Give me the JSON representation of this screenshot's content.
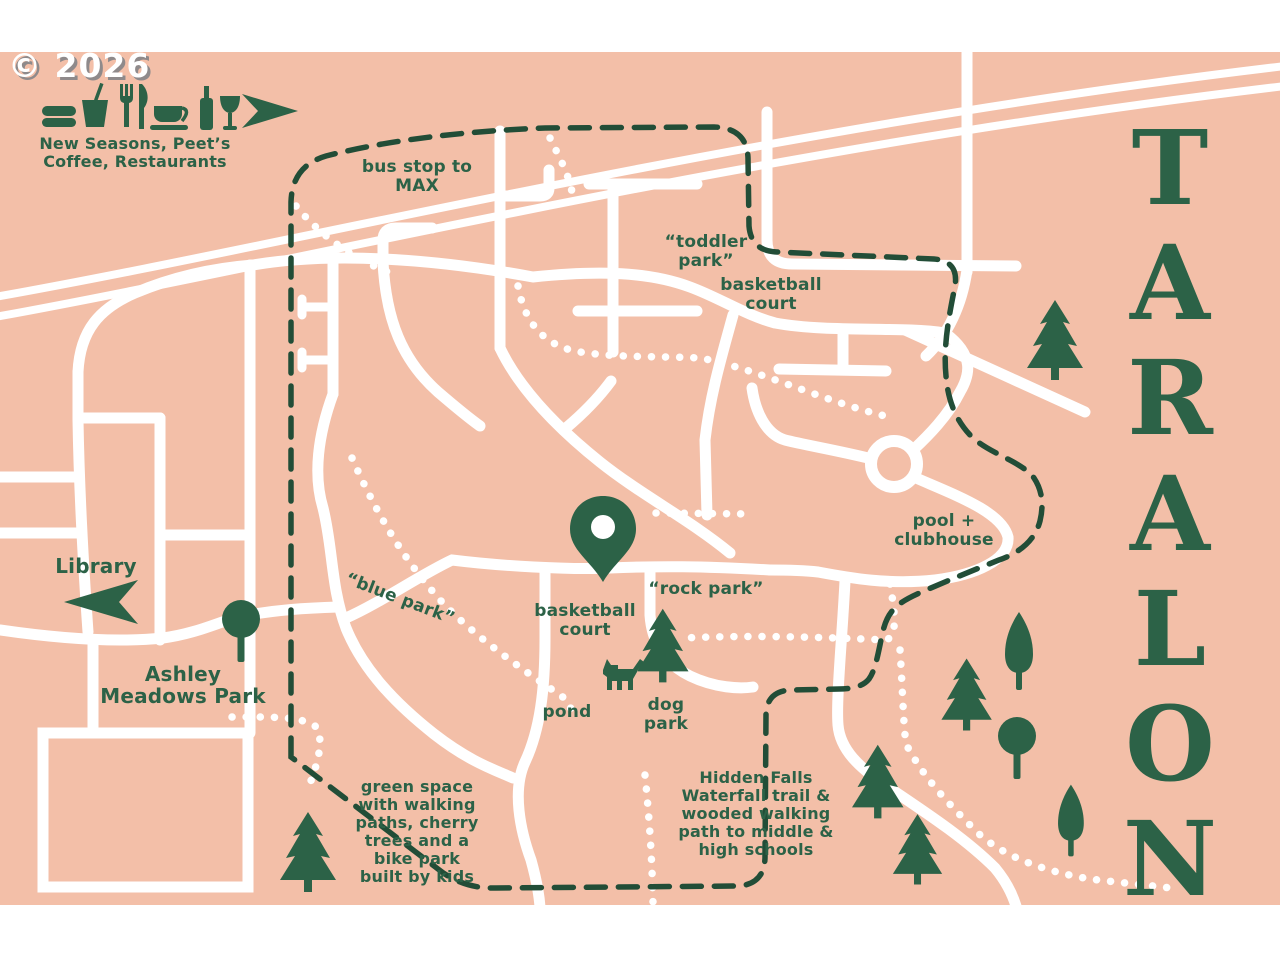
{
  "copyright": "© 2026",
  "title": {
    "text": "TARALON",
    "letters": [
      "T",
      "A",
      "R",
      "A",
      "L",
      "O",
      "N"
    ]
  },
  "colors": {
    "background": "#f3bfa8",
    "green": "#2c6247",
    "dash_green": "#224d37",
    "road": "#ffffff"
  },
  "amenities": {
    "line1": "New Seasons, Peet’s",
    "line2": "Coffee, Restaurants",
    "icons": [
      "burger-icon",
      "drink-icon",
      "fork-icon",
      "knife-icon",
      "coffee-cup-icon",
      "wine-bottle-icon",
      "wine-glass-icon",
      "direction-arrow-icon"
    ]
  },
  "labels": {
    "bus_stop": {
      "line1": "bus stop to",
      "line2": "MAX"
    },
    "toddler_park": {
      "line1": "“toddler",
      "line2": "park”"
    },
    "basketball_court_top": {
      "line1": "basketball",
      "line2": "court"
    },
    "library": "Library",
    "ashley_meadows": {
      "line1": "Ashley",
      "line2": "Meadows Park"
    },
    "blue_park": "“blue park”",
    "basketball_court_mid": {
      "line1": "basketball",
      "line2": "court"
    },
    "rock_park": "“rock park”",
    "pond": "pond",
    "dog_park": {
      "line1": "dog",
      "line2": "park"
    },
    "pool_clubhouse": {
      "line1": "pool +",
      "line2": "clubhouse"
    },
    "green_space": {
      "lines": [
        "green space",
        "with walking",
        "paths, cherry",
        "trees and a",
        "bike park",
        "built by kids"
      ]
    },
    "hidden_falls": {
      "lines": [
        "Hidden Falls",
        "Waterfall trail &",
        "wooded walking",
        "path to middle &",
        "high schools"
      ]
    }
  }
}
